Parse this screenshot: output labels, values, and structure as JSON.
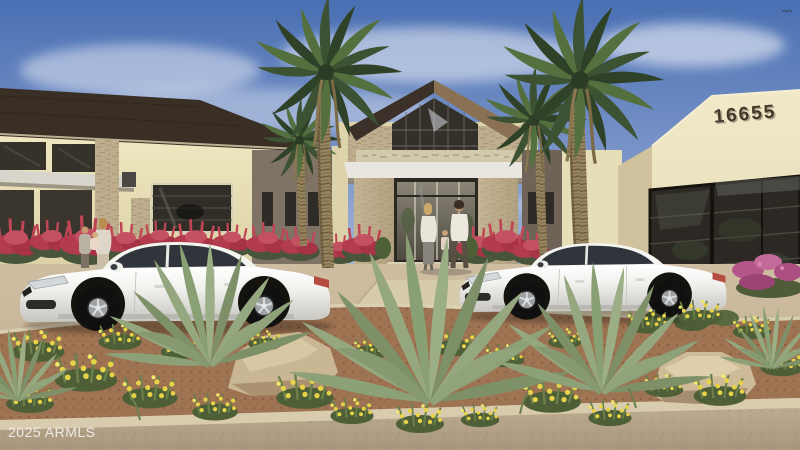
{
  "meta": {
    "description": "Architectural rendering of a single-story commercial clubhouse with desert landscaping, four palm trees, two parked white sedans and people walking toward the glass entry",
    "image_type": "real-estate listing photo",
    "width_px": 800,
    "height_px": 450
  },
  "watermark": {
    "text": "2025 ARMLS"
  },
  "building": {
    "address_number": "16655",
    "stucco_color": "#eae2bb",
    "accent_wall_color": "#7e7365",
    "roof_color": "#3c3128",
    "stone_color": "#c3b394",
    "glass_color": "#2f2b26",
    "canopy_color": "#e9e6df"
  },
  "scene": {
    "sky": {
      "top_color": "#496fb3",
      "horizon_color": "#d6dbe4",
      "clouds": "wispy white"
    },
    "palm_tree_count": 4,
    "car_count": 2,
    "cars": "two white four-door sedans parked facing left",
    "people": [
      "man, woman and child walking toward the entrance",
      "woman holding a child near red flowers at left"
    ],
    "landscaping": [
      "red flowering shrubs along building base",
      "yellow wildflower patches in median",
      "agave plants",
      "sandstone boulders",
      "pink flowers at far right"
    ],
    "ground": {
      "pavement_color": "#c8b69a",
      "dirt_color": "#9e7352",
      "road_color": "#b7a68c"
    }
  }
}
